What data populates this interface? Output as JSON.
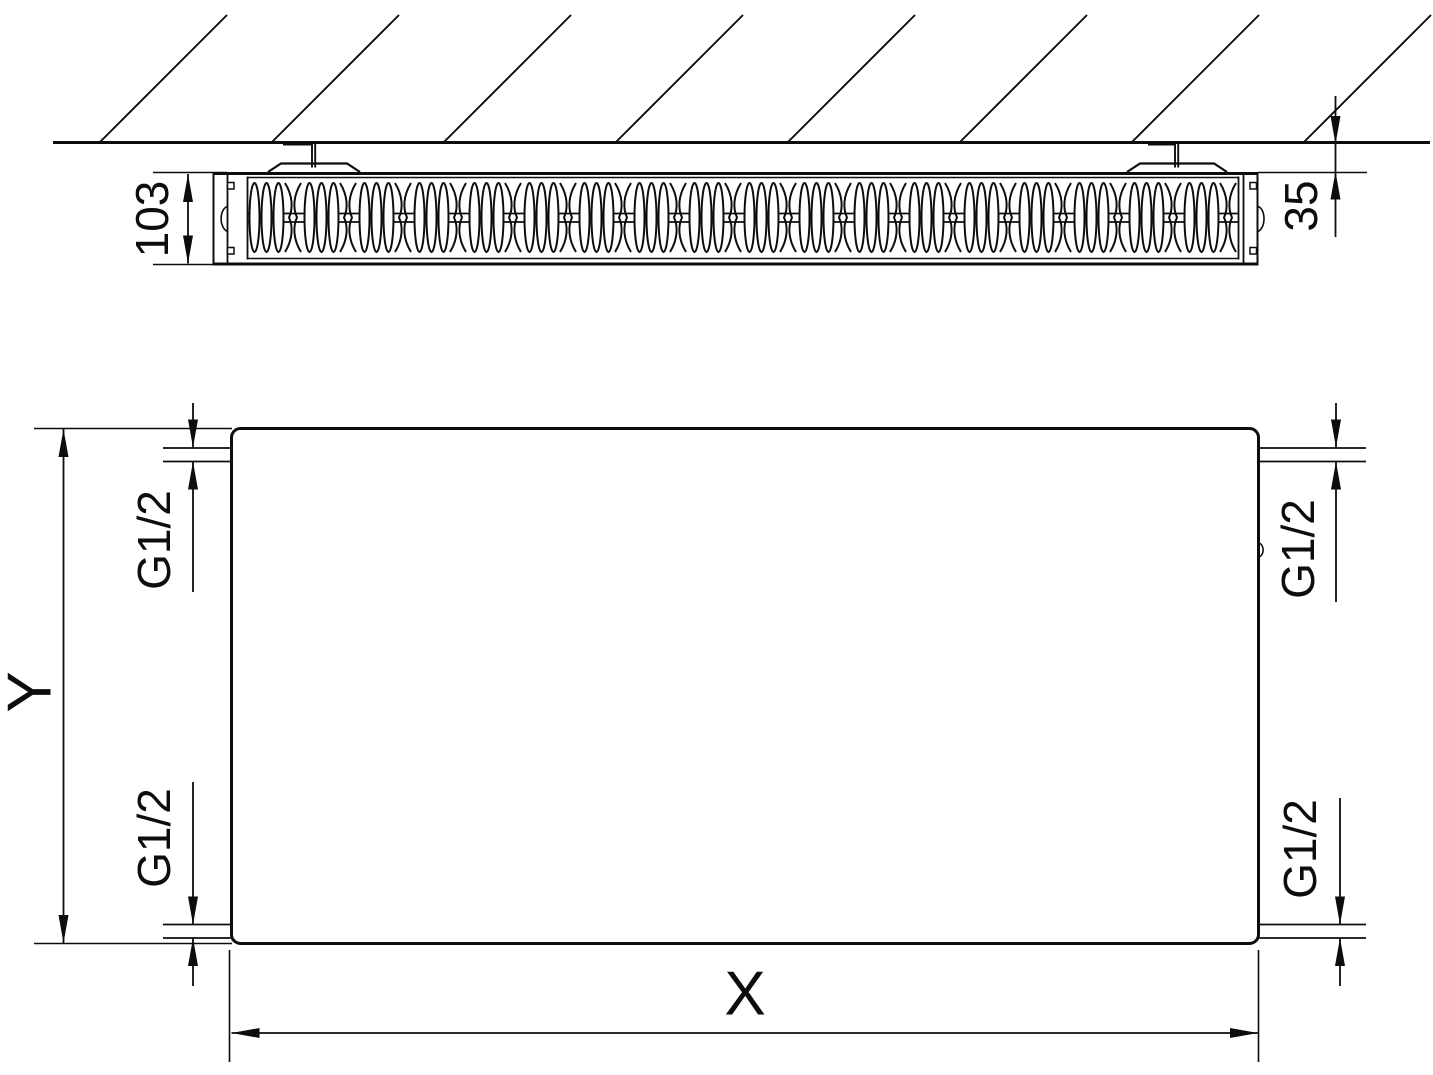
{
  "colors": {
    "line": "#0d0d0d",
    "background": "#ffffff"
  },
  "top_view": {
    "depth_label": "103",
    "wall_gap_label": "35"
  },
  "front_view": {
    "height_label": "Y",
    "width_label": "X",
    "connections": {
      "top_left": "G1/2",
      "bottom_left": "G1/2",
      "top_right": "G1/2",
      "bottom_right": "G1/2"
    }
  }
}
